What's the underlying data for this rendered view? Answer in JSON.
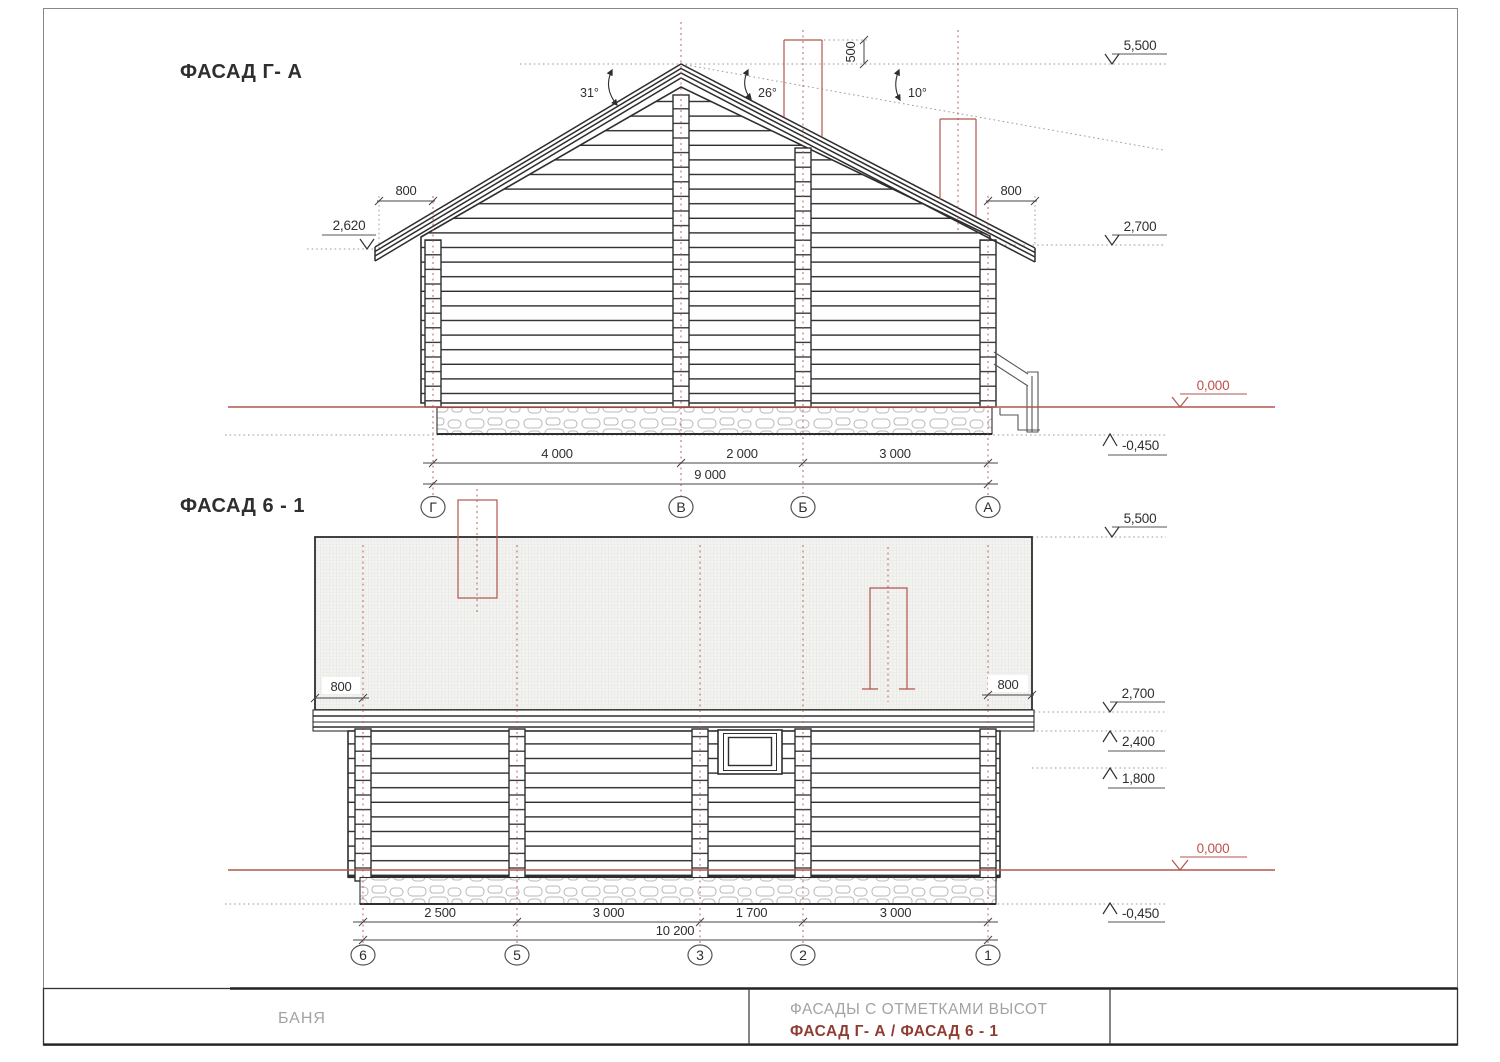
{
  "colors": {
    "line_dark": "#2e2e2e",
    "line_medium": "#555555",
    "dotted_gray": "#9b9b9b",
    "red_line": "#b2564c",
    "red_text": "#c0504d",
    "title_red": "#8f3d33",
    "gray_text": "#a3a3a3",
    "hatch_bg": "#f3f3f1",
    "hatch_line": "#dbdbd6",
    "stone_line": "#b8b8b8"
  },
  "facade_ga": {
    "title": "ФАСАД Г- А",
    "angle_left": "31°",
    "angle_right": "26°",
    "angle_low": "10°",
    "dim_chimney": "500",
    "dim_overhang_left": "800",
    "dim_overhang_right": "800",
    "level_ridge": "5,500",
    "level_eave_left": "2,620",
    "level_eave_right": "2,700",
    "level_zero": "0,000",
    "level_foundation": "-0,450",
    "dim_spans": [
      "4 000",
      "2 000",
      "3 000"
    ],
    "dim_total": "9 000",
    "axes": [
      "Г",
      "В",
      "Б",
      "А"
    ]
  },
  "facade_61": {
    "title": "ФАСАД 6 - 1",
    "dim_overhang_left": "800",
    "dim_overhang_right": "800",
    "level_ridge": "5,500",
    "level_eave": "2,700",
    "level_wall_top": "2,400",
    "level_window": "1,800",
    "level_zero": "0,000",
    "level_foundation": "-0,450",
    "dim_spans": [
      "2 500",
      "3 000",
      "1 700",
      "3 000"
    ],
    "dim_total": "10 200",
    "axes": [
      "6",
      "5",
      "3",
      "2",
      "1"
    ]
  },
  "title_block": {
    "object_name": "БАНЯ",
    "sheet_title": "ФАСАДЫ С ОТМЕТКАМИ ВЫСОТ",
    "sheet_subtitle": "ФАСАД Г- А / ФАСАД 6 - 1"
  }
}
